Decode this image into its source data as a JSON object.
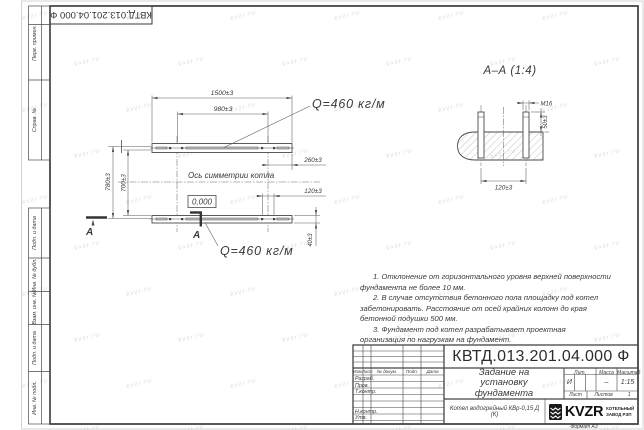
{
  "watermark": {
    "text": "kvzr.ru"
  },
  "corner_stamp": {
    "doc_number": "КВТД.013.201.04.000 Ф"
  },
  "margin": {
    "perv": "Перв. примен.",
    "sprav": "Справ. №",
    "podp1": "Подп. и дата",
    "inv_dubl": "Инв. № дубл.",
    "vzam": "Взам. инв. №",
    "podp2": "Подп. и дата",
    "inv_podl": "Инв. № подл."
  },
  "plan": {
    "dim_1500": "1500±3",
    "dim_980": "980±3",
    "dim_780": "780±3",
    "dim_700": "700±3",
    "dim_260": "260±3",
    "dim_120": "120±3",
    "dim_40": "40±3",
    "load_top": "Q=460 кг/м",
    "load_bottom": "Q=460 кг/м",
    "axis": "Ось симметрии котла",
    "level": "0,000",
    "section_a_left": "А",
    "section_a_mid": "А"
  },
  "section": {
    "title": "А–А (1:4)",
    "thread": "М16",
    "dim_50": "50±3",
    "dim_120": "120±3"
  },
  "notes": {
    "n1": "1. Отклонение от горизонтального уровня верхней поверхности фундамента не более 10 мм.",
    "n2": "2. В случае отсутствия бетонного пола площадку под котел забетонировать. Расстояние от осей крайних колонн до края бетонной подушки 500 мм.",
    "n3": "3. Фундамент под котел разрабатывает проектная организация по нагрузкам на фундамент."
  },
  "title_block": {
    "doc_number": "КВТД.013.201.04.000 Ф",
    "doc_title": "Задание на установку фундамента",
    "product": "Котел водогрейный КВр-0,15 Д (К)",
    "col_izm": "Изм.",
    "col_list": "Лист",
    "col_doc": "№ докум.",
    "col_podp": "Подп.",
    "col_data": "Дата",
    "row_razrab": "Разраб.",
    "row_prov": "Пров.",
    "row_tkontr": "Т.контр.",
    "row_nkontr": "Н.контр.",
    "row_utv": "Утв.",
    "lit_label": "Лит.",
    "lit_value": "И",
    "massa_label": "Масса",
    "massa_value": "–",
    "masshtab_label": "Масштаб",
    "masshtab_value": "1:15",
    "list_label": "Лист",
    "listov_label": "Листов",
    "listov_value": "1",
    "logo": "KVZR",
    "logo_line1": "КОТЕЛЬНЫЙ",
    "logo_line2": "ЗАВОД РЭП",
    "format": "Формат А3"
  }
}
